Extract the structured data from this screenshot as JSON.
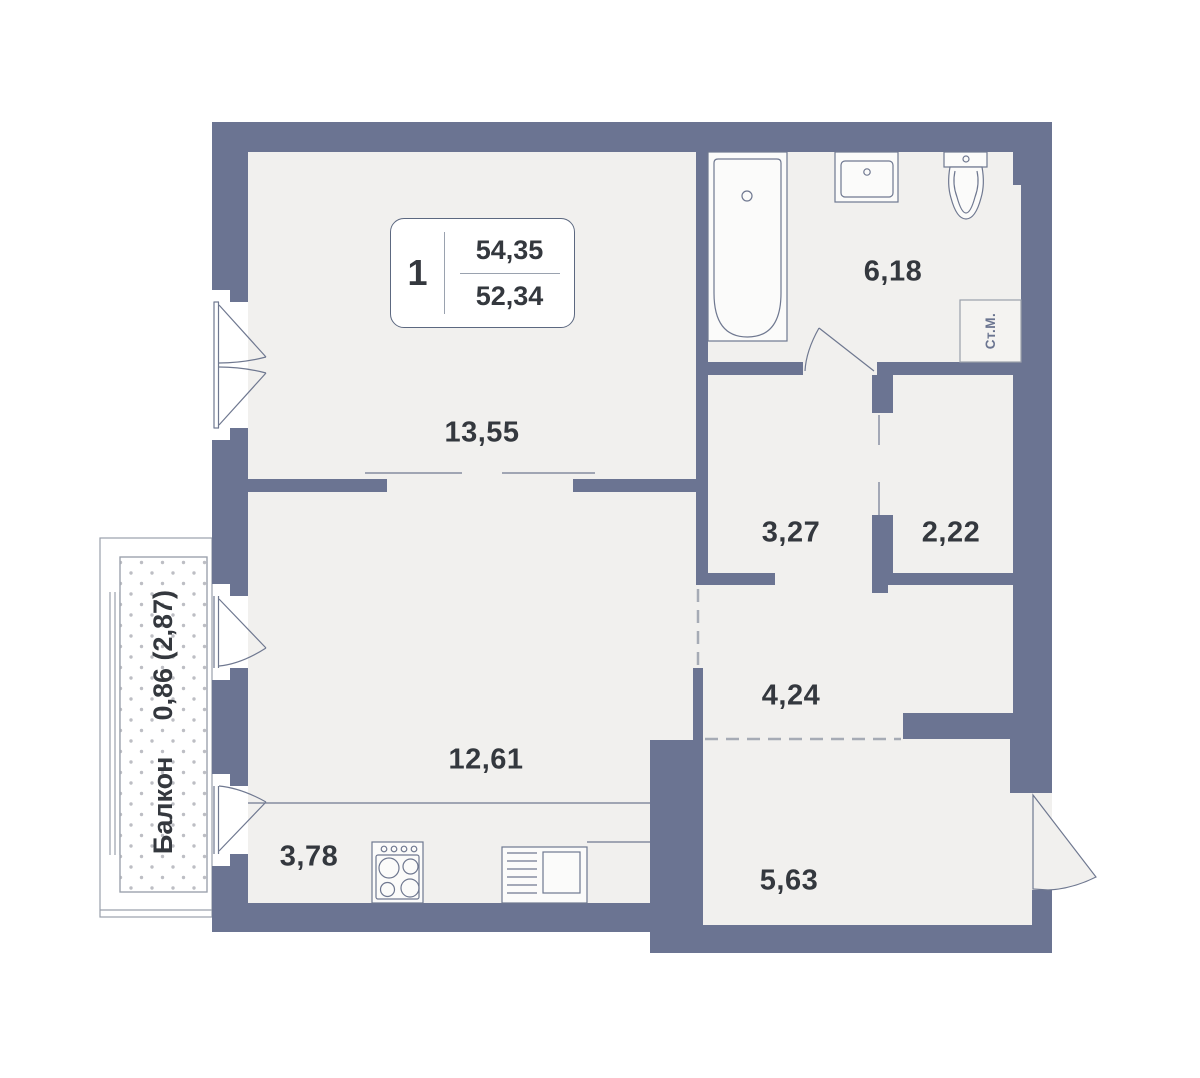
{
  "unit_card": {
    "rooms_count": "1",
    "area_total": "54,35",
    "area_living": "52,34"
  },
  "room_labels": {
    "bedroom": "13,55",
    "bathroom": "6,18",
    "wardrobe": "3,27",
    "closet": "2,22",
    "hallway": "4,24",
    "living": "12,61",
    "kitchen": "3,78",
    "entry": "5,63"
  },
  "balcony": {
    "name": "Балкон",
    "area": "0,86 (2,87)"
  },
  "appliances": {
    "washing_machine": "Ст.М."
  },
  "colors": {
    "wall": "#6b7492",
    "floor": "#f1f0ee",
    "text": "#34383e",
    "dash": "#a6abb5",
    "thin_line": "#6f7890"
  }
}
